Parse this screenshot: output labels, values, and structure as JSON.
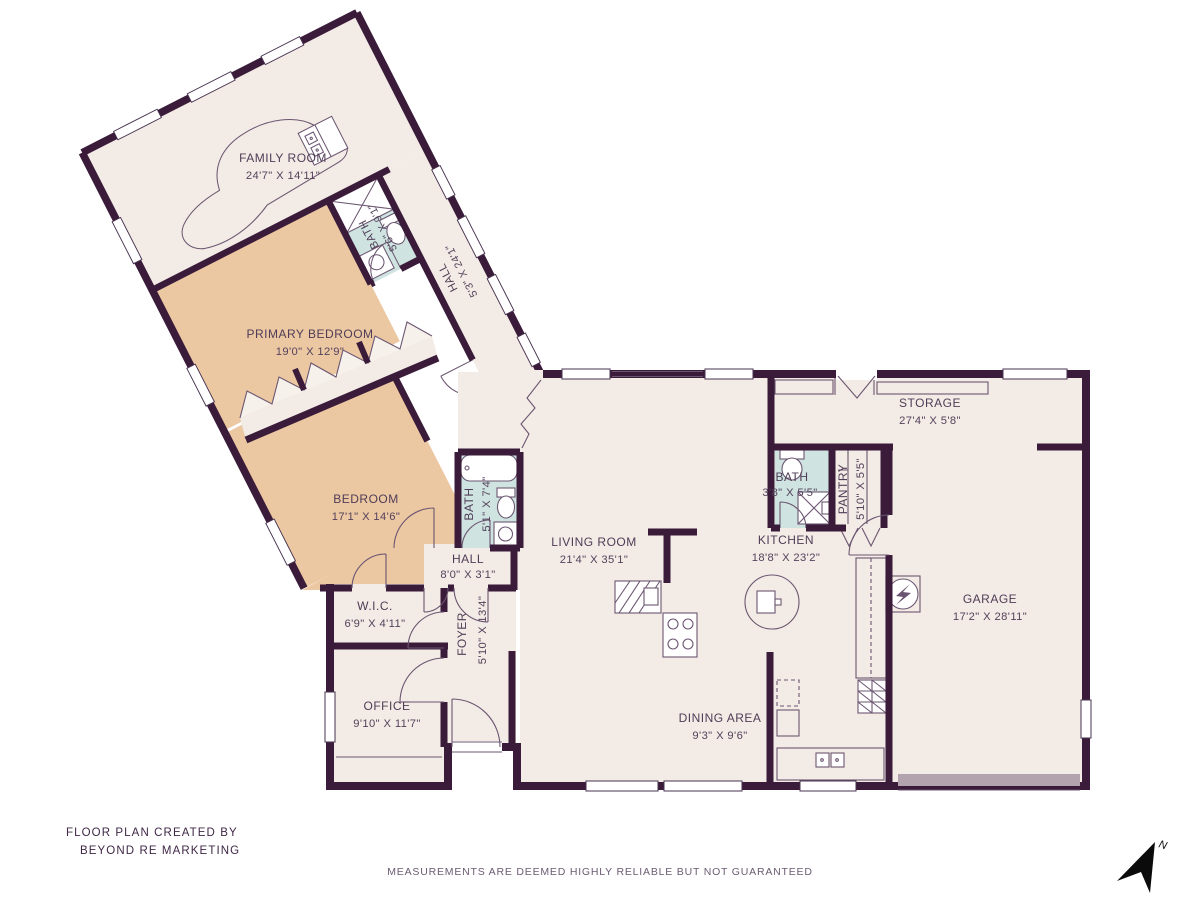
{
  "title_block": {
    "credit_line1": "FLOOR PLAN CREATED BY",
    "credit_line2": "BEYOND RE MARKETING",
    "disclaimer": "MEASUREMENTS ARE DEEMED HIGHLY RELIABLE BUT NOT GUARANTEED",
    "compass_label": "N"
  },
  "rooms": {
    "family_room": {
      "name": "FAMILY ROOM",
      "dims": "24'7\" X 14'11\""
    },
    "bath_wing": {
      "name": "BATH",
      "dims": "5'6\" X 9'1\""
    },
    "hall_wing": {
      "name": "HALL",
      "dims": "5'3\" X 24'1\""
    },
    "primary_bedroom": {
      "name": "PRIMARY BEDROOM",
      "dims": "19'0\" X 12'9\""
    },
    "bedroom": {
      "name": "BEDROOM",
      "dims": "17'1\" X 14'6\""
    },
    "bath2": {
      "name": "BATH",
      "dims": "5'1\" X 7'4\""
    },
    "hall2": {
      "name": "HALL",
      "dims": "8'0\" X 3'1\""
    },
    "wic": {
      "name": "W.I.C.",
      "dims": "6'9\" X 4'11\""
    },
    "office": {
      "name": "OFFICE",
      "dims": "9'10\" X 11'7\""
    },
    "foyer": {
      "name": "FOYER",
      "dims": "5'10\" X 13'4\""
    },
    "living_room": {
      "name": "LIVING ROOM",
      "dims": "21'4\" X 35'1\""
    },
    "dining_area": {
      "name": "DINING AREA",
      "dims": "9'3\" X 9'6\""
    },
    "kitchen": {
      "name": "KITCHEN",
      "dims": "18'8\" X 23'2\""
    },
    "bath3": {
      "name": "BATH",
      "dims": "3'8\" X 5'5\""
    },
    "pantry": {
      "name": "PANTRY",
      "dims": "5'10\" X 5'5\""
    },
    "storage": {
      "name": "STORAGE",
      "dims": "27'4\" X 5'8\""
    },
    "garage": {
      "name": "GARAGE",
      "dims": "17'2\" X 28'11\""
    }
  },
  "colors": {
    "wall": "#3a1b3a",
    "floor": "#f3ebe5",
    "bedroom_fill": "#ebc7a2",
    "bath_fill": "#cfe4e1",
    "accent_line": "#6b5671",
    "text": "#4f3d57"
  }
}
